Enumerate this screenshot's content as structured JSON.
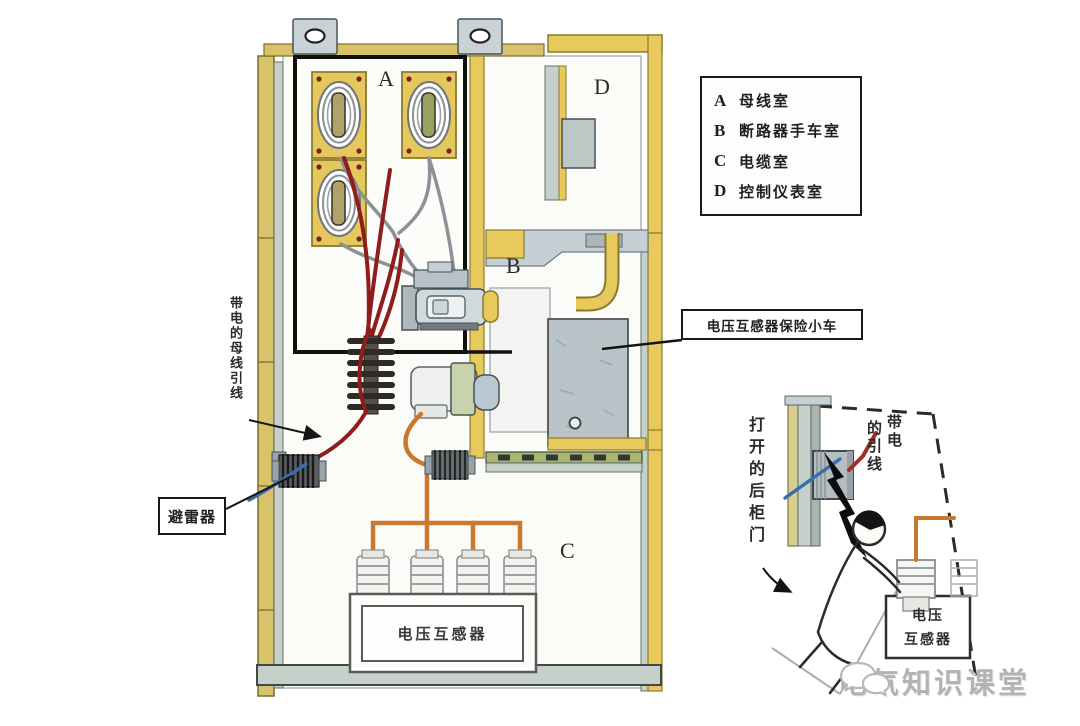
{
  "legend": {
    "items": [
      {
        "key": "A",
        "label": "母线室"
      },
      {
        "key": "B",
        "label": "断路器手车室"
      },
      {
        "key": "C",
        "label": "电缆室"
      },
      {
        "key": "D",
        "label": "控制仪表室"
      }
    ]
  },
  "compartments": {
    "a": "A",
    "b": "B",
    "c": "C",
    "d": "D"
  },
  "callouts": {
    "live_busbar_lead": "带电的母线引线",
    "arrester": "避雷器",
    "vt_fuse_cart": "电压互感器保险小车",
    "vt_main": "电压互感器",
    "opened_rear_door": "打开的后柜门",
    "live_lead_right": "带电",
    "live_lead_left": "的引线",
    "vt_mini_line1": "电压",
    "vt_mini_line2": "互感器"
  },
  "watermark": {
    "text": "电气知识课堂",
    "icon": "chat-bubbles-icon"
  },
  "colors": {
    "panel_yellow": "#e8ca5c",
    "panel_tan": "#d9c36a",
    "panel_gray": "#c5d0ca",
    "wire_red": "#8f1d1d",
    "wire_orange": "#c9792f",
    "wire_blue": "#3a6ea8"
  }
}
